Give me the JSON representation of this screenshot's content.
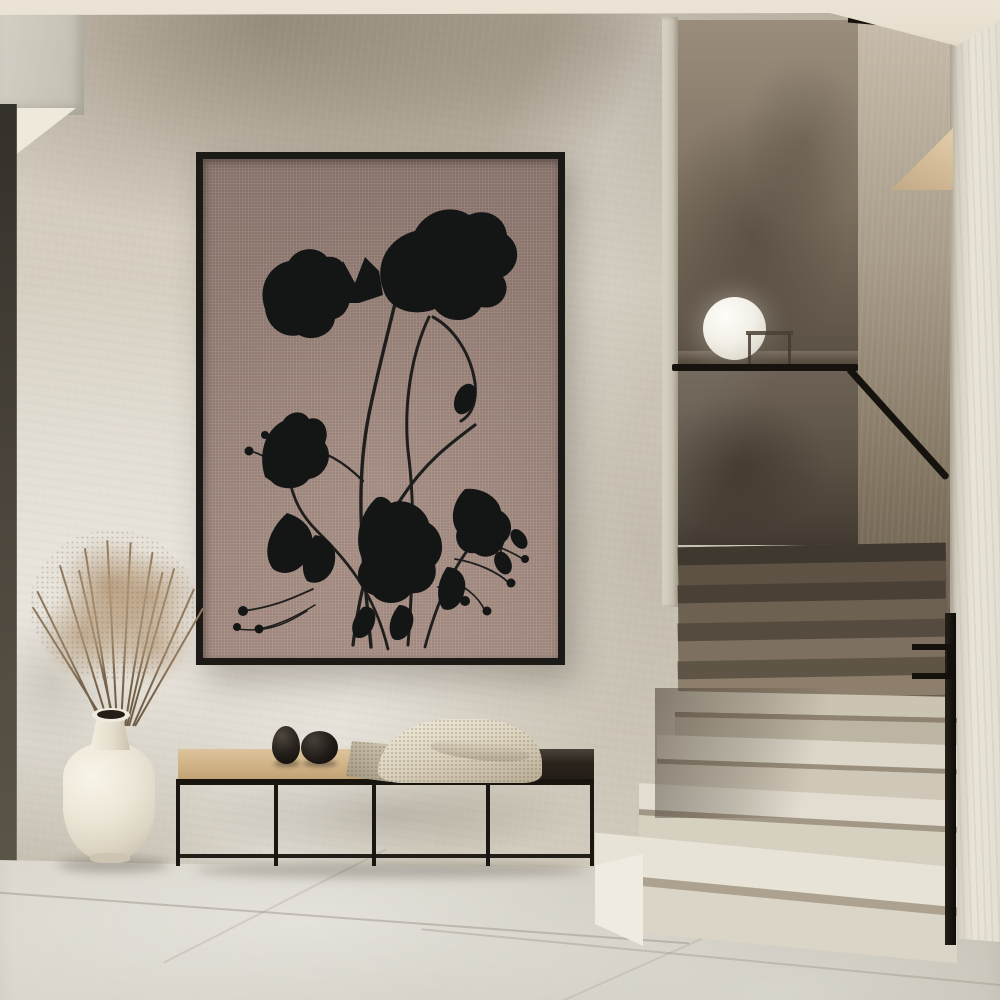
{
  "scene": {
    "type": "interior photograph",
    "alt": "Minimalist hallway with a framed botanical art print on a plaster wall, a black metal bench with decor, a cream vase with dried grass, and a turning terrazzo staircase with a glass balustrade",
    "wall": {
      "finish": "textured plaster",
      "base_color": "#d6d0c2",
      "shadow_tint": "#8e8271",
      "ceiling_color": "#e9e2d4",
      "left_door_edge_color": "#46413a"
    },
    "floor": {
      "material": "large stone tiles",
      "color": "#d2cec3",
      "seam_color": "#8a8274"
    },
    "artwork": {
      "alt": "Black ink botanical silhouettes of wildflowers, leaves, seed pods and berries on mauve linen canvas in a thin black frame",
      "frame_color": "#1c1a17",
      "canvas_color": "#978077",
      "ink_color": "#151716",
      "subject": "wildflower stems crossing with poppy-like blooms, tulips, leaves and berry stalks"
    },
    "bench": {
      "alt": "Low bench with tan cushion, dark wood section and thin black metal frame",
      "cushion_color": "#d0b287",
      "dark_top_color": "#2b241d",
      "frame_color": "#1a1713",
      "leg_count": 5,
      "decor_balls": [
        {
          "shape": "egg",
          "color": "#17130f"
        },
        {
          "shape": "sphere",
          "color": "#1b1613"
        }
      ],
      "blanket": {
        "material": "knit throw",
        "color": "#d9d0bc"
      }
    },
    "vase": {
      "alt": "Cream ceramic floor vase with dried grass spray",
      "body_color": "#efe9dc",
      "contents": "dried grass",
      "grass_color": "#a98f6f"
    },
    "staircase": {
      "alt": "Terrazzo staircase turning up to a half landing with smoked glass balustrade and black handrail",
      "lower_step_color": "#e2ddd0",
      "upper_step_color": "#7b6e5e",
      "handrail_color": "#15120e",
      "balustrade_color": "#5a5044",
      "right_pillar_color": "#e8e3d7",
      "stringer_color": "#d8c19e",
      "trim_color": "#15120e",
      "lamp": {
        "shape": "sphere",
        "color": "#fbfaf6",
        "position": "on half-landing ledge"
      },
      "side_table_color": "#4a4034"
    }
  }
}
